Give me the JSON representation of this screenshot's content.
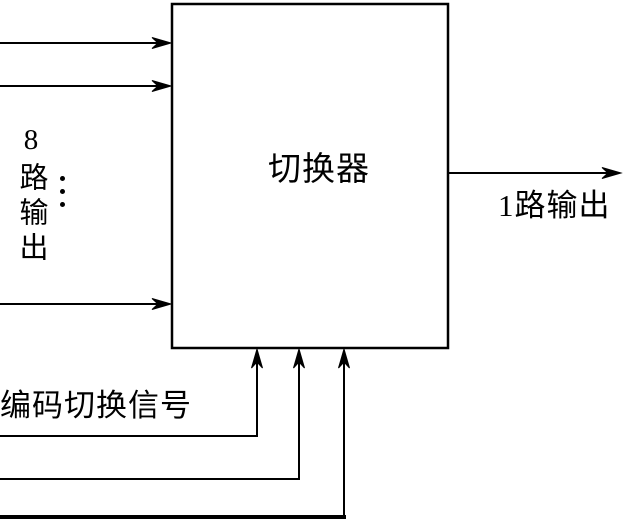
{
  "diagram": {
    "type": "block-diagram",
    "background_color": "#ffffff",
    "line_color": "#000000",
    "block": {
      "label": "切换器"
    },
    "inputs": {
      "label": "8路输出",
      "arrows_shown": 3,
      "ellipsis_icon": "vertical-ellipsis"
    },
    "output": {
      "label": "1路输出"
    },
    "control": {
      "label": "编码切换信号",
      "arrows_shown": 3
    }
  }
}
